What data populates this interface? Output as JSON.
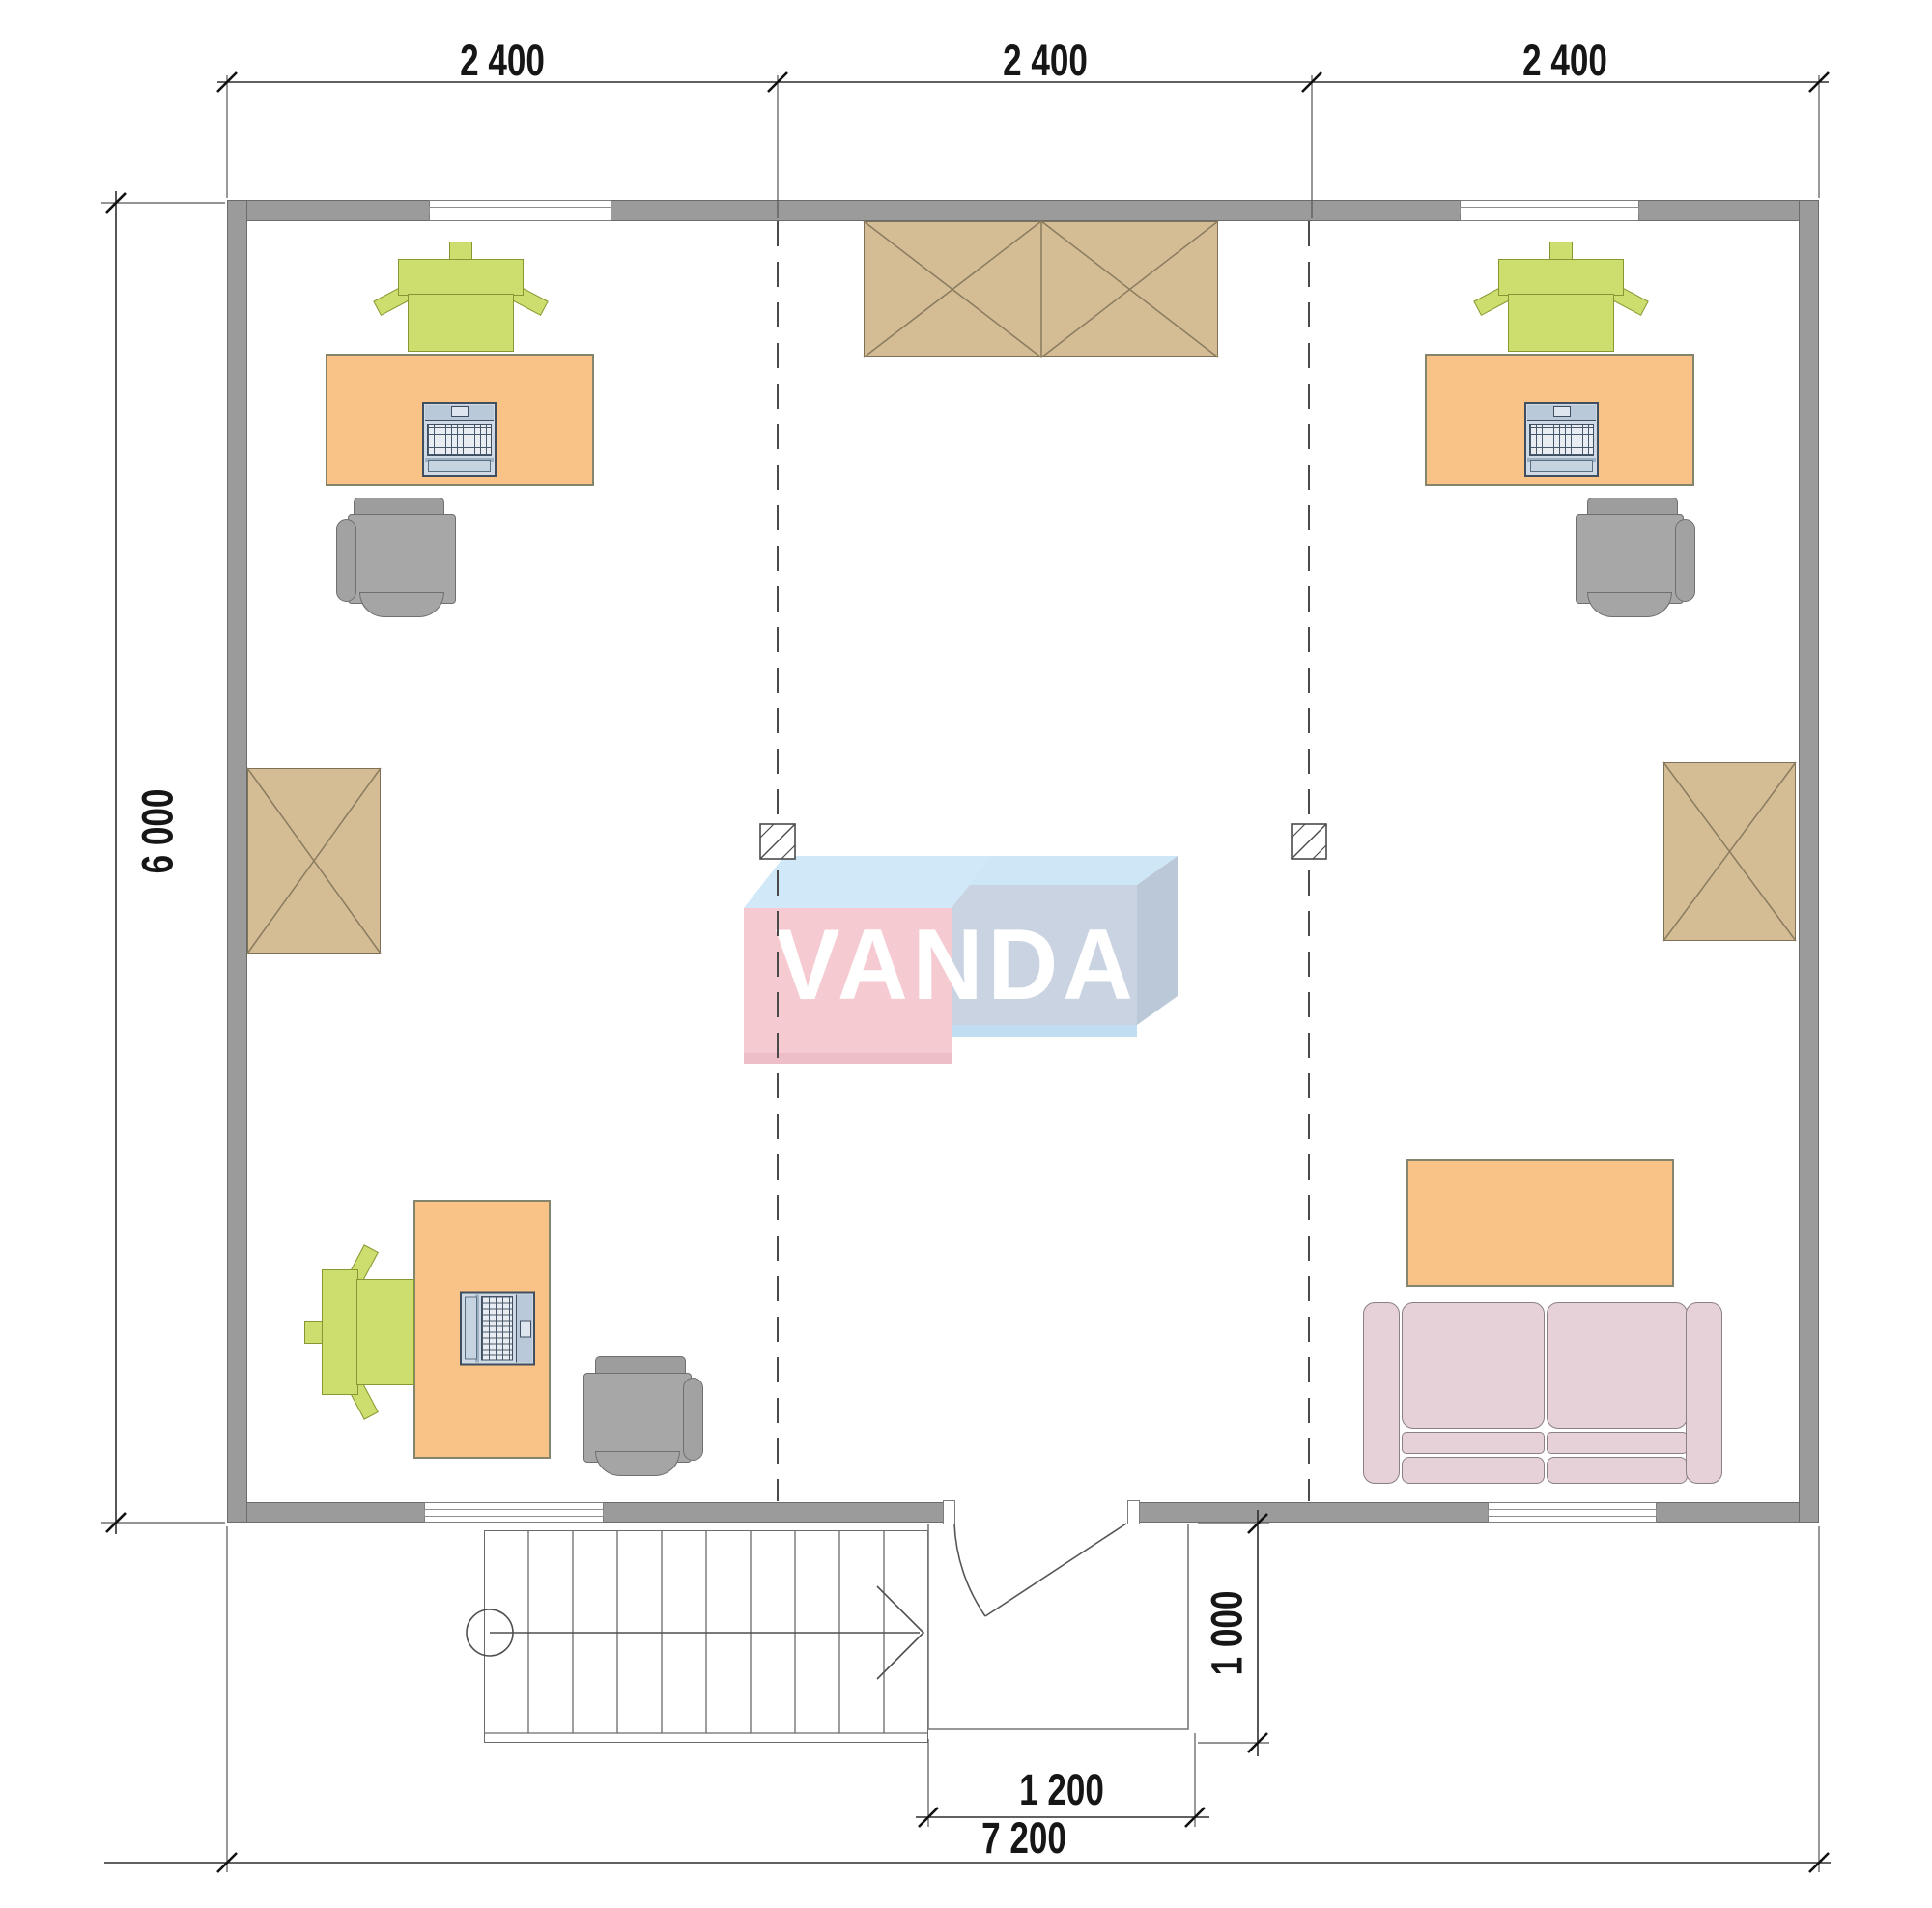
{
  "drawing": {
    "title": "floor-plan",
    "watermark": {
      "text": "VANDA"
    },
    "dimensions": {
      "top_segments": [
        "2 400",
        "2 400",
        "2 400"
      ],
      "side_height": "6 000",
      "entry_width": "1 200",
      "entry_depth": "1 000",
      "total_width": "7 200"
    },
    "colors": {
      "wall": "#9b9b9b",
      "desk": "#f9c387",
      "task_chair": "#cede6e",
      "office_chair": "#a7a7a7",
      "cabinet": "#d4bc95",
      "sofa": "#e5d1d7",
      "laptop": "#cfdae6",
      "watermark_pink": "#f5c8d0",
      "watermark_light_blue": "#cfe8f8",
      "watermark_steel_blue": "#c7d2e0",
      "dimension_text": "#161616"
    }
  }
}
